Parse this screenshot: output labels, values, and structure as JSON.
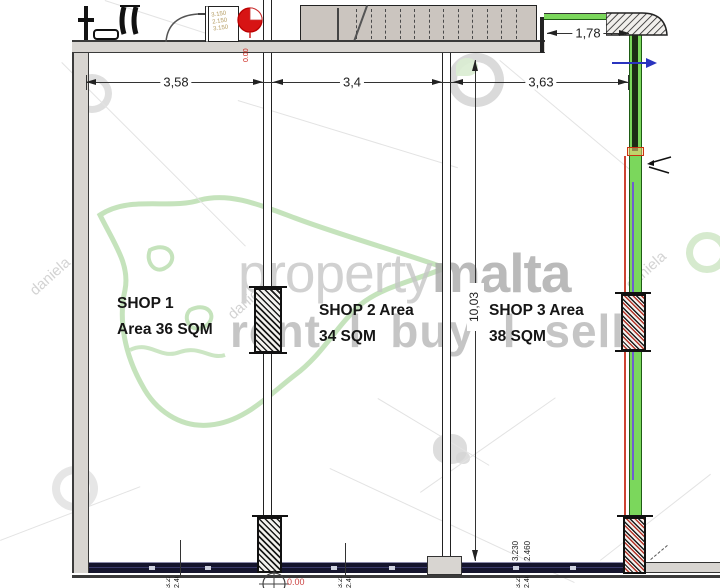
{
  "shops": [
    {
      "name": "SHOP 1",
      "area": "Area 36 SQM"
    },
    {
      "name": "SHOP 2 Area",
      "area": "34 SQM"
    },
    {
      "name": "SHOP 3 Area",
      "area": "38 SQM"
    }
  ],
  "dimensions": {
    "shop1_width": "3,58",
    "shop2_width": "3,4",
    "shop3_width": "3,63",
    "right_recess": "1,78",
    "shop_depth": "10,03",
    "front_height_a": "3.230",
    "front_height_b": "2.460",
    "front_level": "0.00",
    "back_level": "0.00",
    "closet_note_a": "3.150",
    "closet_note_b": "2.150"
  },
  "watermark": {
    "brand_light": "property",
    "brand_bold": "malta",
    "tagline": "rent l buy l sell",
    "agent": "daniela"
  },
  "colors": {
    "wall_gray": "#d8d5d1",
    "storefront_navy": "#15152d",
    "glazing_green": "#7bd75c",
    "accent_red": "#cc2218",
    "accent_blue": "#2a34bf",
    "accent_purple": "#6f5fd0",
    "watermark_gray": "#bcbcbc",
    "malta_outline_green": "#b7dcab",
    "note_tan": "#b39a5e"
  }
}
